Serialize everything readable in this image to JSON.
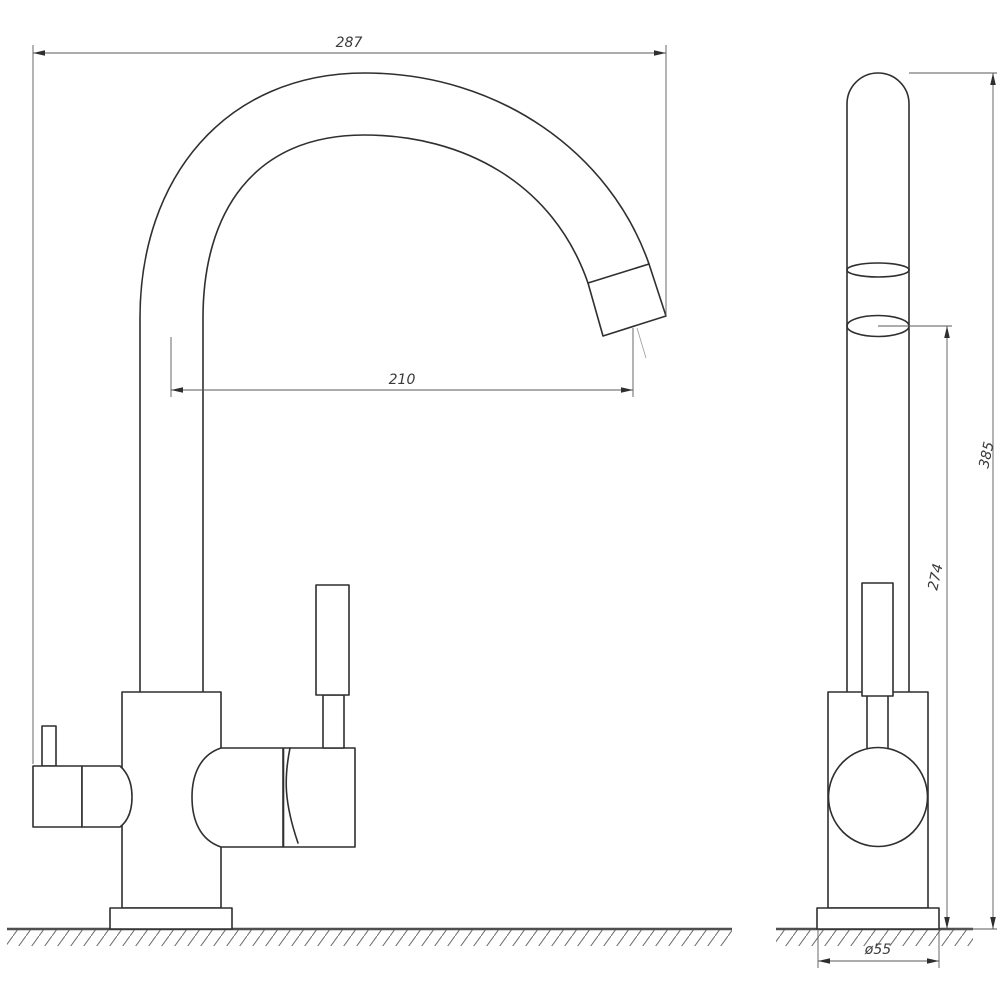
{
  "drawing": {
    "kind": "technical-drawing",
    "subject": "kitchen-faucet-two-views",
    "background": "#ffffff",
    "line_color": "#2f2f2f",
    "dim_line_color": "#5a5a5a",
    "text_color": "#3a3a3a"
  },
  "views": {
    "front": "front-view",
    "side": "side-view"
  },
  "dims": {
    "front_width": "287",
    "front_reach": "210",
    "side_height": "385",
    "side_spout_height": "274",
    "base_diameter": "ø55"
  }
}
